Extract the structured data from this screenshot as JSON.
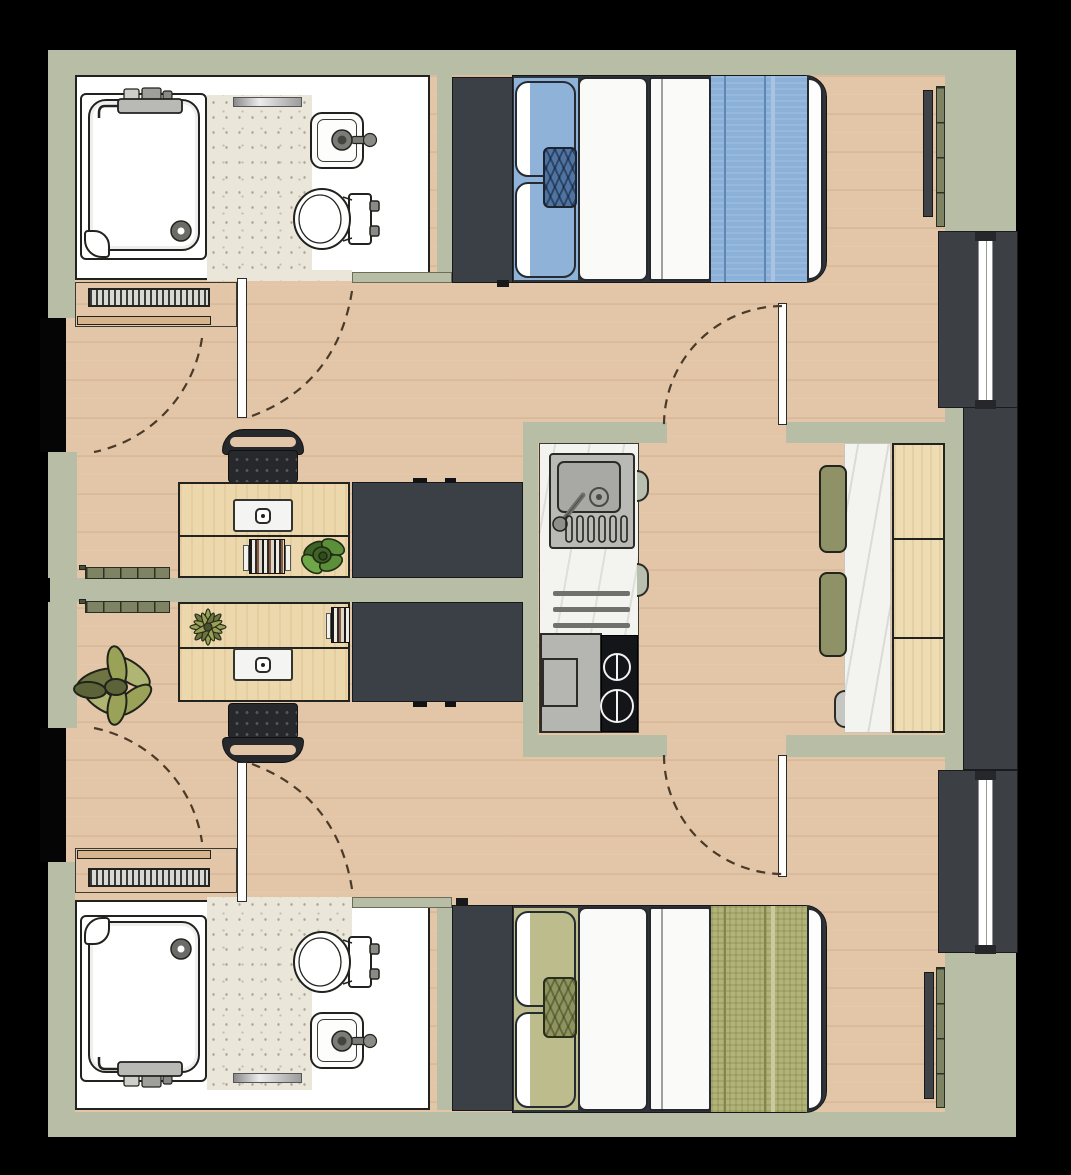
{
  "plan": {
    "type": "floor-plan",
    "units": [
      {
        "name": "studio-a",
        "position": "top",
        "bed": "double-bed-blue",
        "areas": [
          "bathroom",
          "entry-hall",
          "sleeping-area",
          "desk-area"
        ],
        "fixtures": [
          "shower",
          "toilet",
          "hand-basin",
          "radiator",
          "wardrobe",
          "desk",
          "office-chair",
          "laptop",
          "books",
          "desk-plant"
        ]
      },
      {
        "name": "studio-b",
        "position": "bottom",
        "bed": "double-bed-olive",
        "areas": [
          "bathroom",
          "entry-hall",
          "sleeping-area",
          "desk-area"
        ],
        "fixtures": [
          "shower",
          "toilet",
          "hand-basin",
          "radiator",
          "wardrobe",
          "desk",
          "office-chair",
          "laptop",
          "books",
          "spiky-plant",
          "floor-plant"
        ]
      }
    ],
    "shared": {
      "name": "kitchen-dining",
      "fixtures": [
        "kitchenette-counter",
        "kitchen-sink",
        "two-burner-cooktop",
        "appliance-block",
        "dining-table",
        "bench-seat",
        "stool-cushions"
      ]
    },
    "windows": 2,
    "exterior_radiators": 2,
    "doors": 6
  },
  "colors": {
    "background": "#000000",
    "wall": "#b8bda6",
    "outline": "#22221e",
    "floor_wood": "#e3c6a8",
    "tile": "#eae7da",
    "white_fixture": "#ffffff",
    "wardrobe": "#3a4046",
    "window_frame": "#3c3f44",
    "glazing": "#ffffff",
    "bed_frame": "#2f343a",
    "blue_sheet": "#8fb2d8",
    "blue_cushion": "#4f74a1",
    "blue_blanket": "#8cb1d8",
    "blue_blanket_line": "#5f87b4",
    "olive_sheet": "#bcbc8d",
    "olive_cushion": "#8e935f",
    "olive_blanket": "#b2b378",
    "olive_blanket_line": "#83854f",
    "duvet": "#fafaf8",
    "desk_wood": "#ecd8ac",
    "bench_wood": "#eedcb2",
    "chair": "#26282b",
    "chair_dot": "#53565c",
    "steel": "#b9bab5",
    "steel_deep": "#a8a9a4",
    "stove": "#141518",
    "appliance": "#b5b6b1",
    "marble": "#f3f3f0",
    "stool": "#8e9266",
    "radiator_fin": "#7e8463",
    "radiator_bar": "#3f4347",
    "radiator_stripe": "#d8d8d4",
    "shelf_tan": "#d6b48c",
    "plant_green": "#5c8f3a",
    "plant_green_dark": "#3f6326",
    "plant_olive": "#9aa257",
    "plant_olive_dark": "#6e7542",
    "door_leaf": "#ffffff",
    "door_arc": "#4a3a28"
  }
}
